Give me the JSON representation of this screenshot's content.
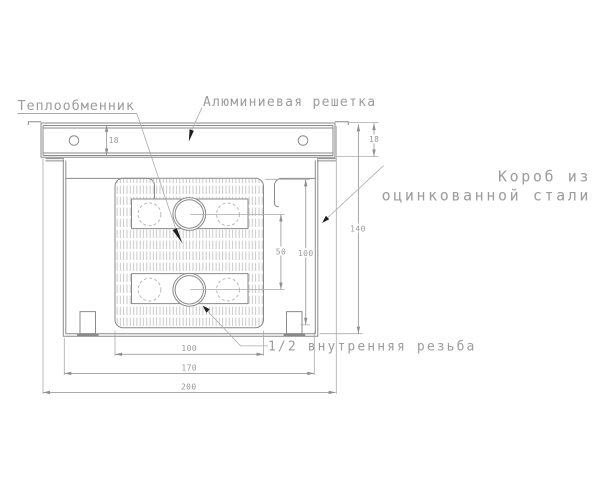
{
  "drawing": {
    "title_hint": "convector cross-section technical drawing",
    "labels": {
      "heat_exchanger": "Теплообменник",
      "aluminum_grille": "Алюминиевая решетка",
      "box_line1": "Короб из",
      "box_line2": "оцинкованной стали",
      "thread": "1/2 внутренняя резьба"
    },
    "dims": {
      "grille_height_left": "18",
      "grille_height_right": "18",
      "box_height": "140",
      "core_height": "100",
      "tube_row_spacing": "50",
      "core_width": "100",
      "box_width": "170",
      "grille_width": "200"
    },
    "colors": {
      "line": "#8a8a8a",
      "dimension": "#9e9e9e",
      "text": "#9c9c9c",
      "leader_arrow": "#1e1e1e",
      "hatch": "#bcbcbc",
      "background": "#ffffff"
    }
  }
}
